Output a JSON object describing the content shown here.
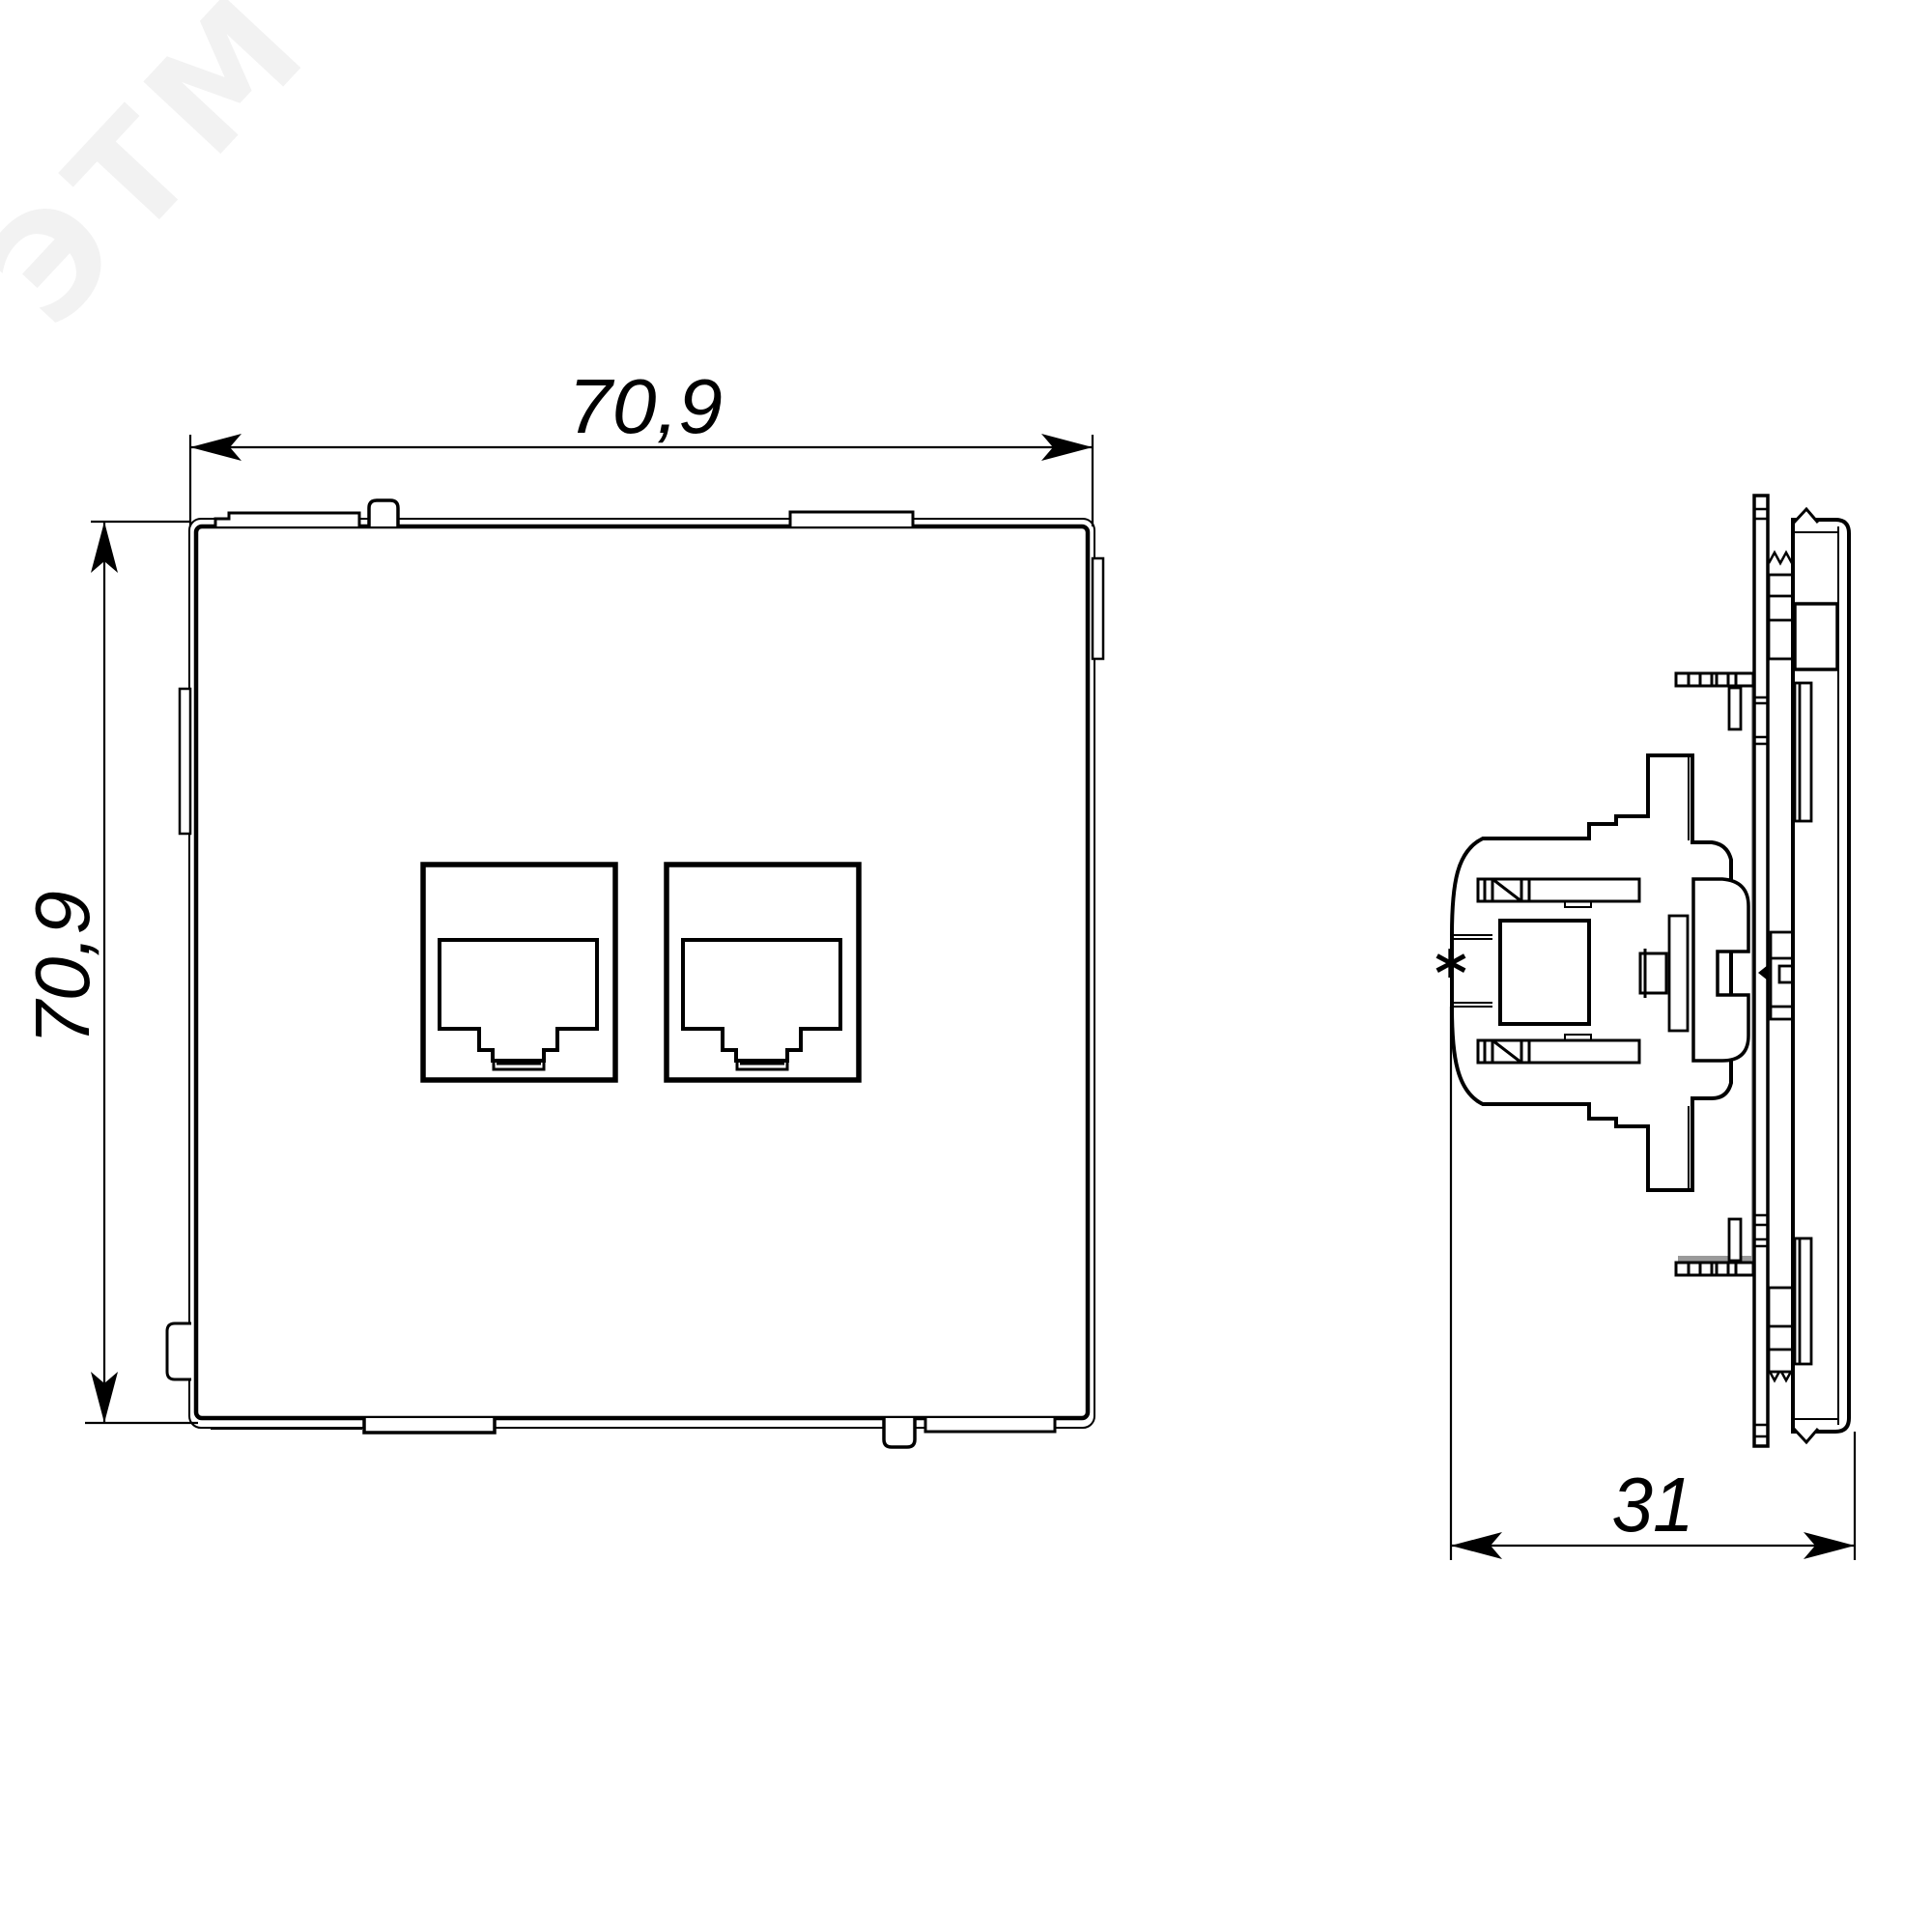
{
  "colors": {
    "background": "#ffffff",
    "line": "#000000",
    "gray_band": "#9a9a9a",
    "watermark": "#f2f2f2"
  },
  "watermark": {
    "text": "ЭТМ"
  },
  "dimensions": {
    "front_width": "70,9",
    "front_height": "70,9",
    "side_depth": "31",
    "depth_reference_marker": "*"
  }
}
